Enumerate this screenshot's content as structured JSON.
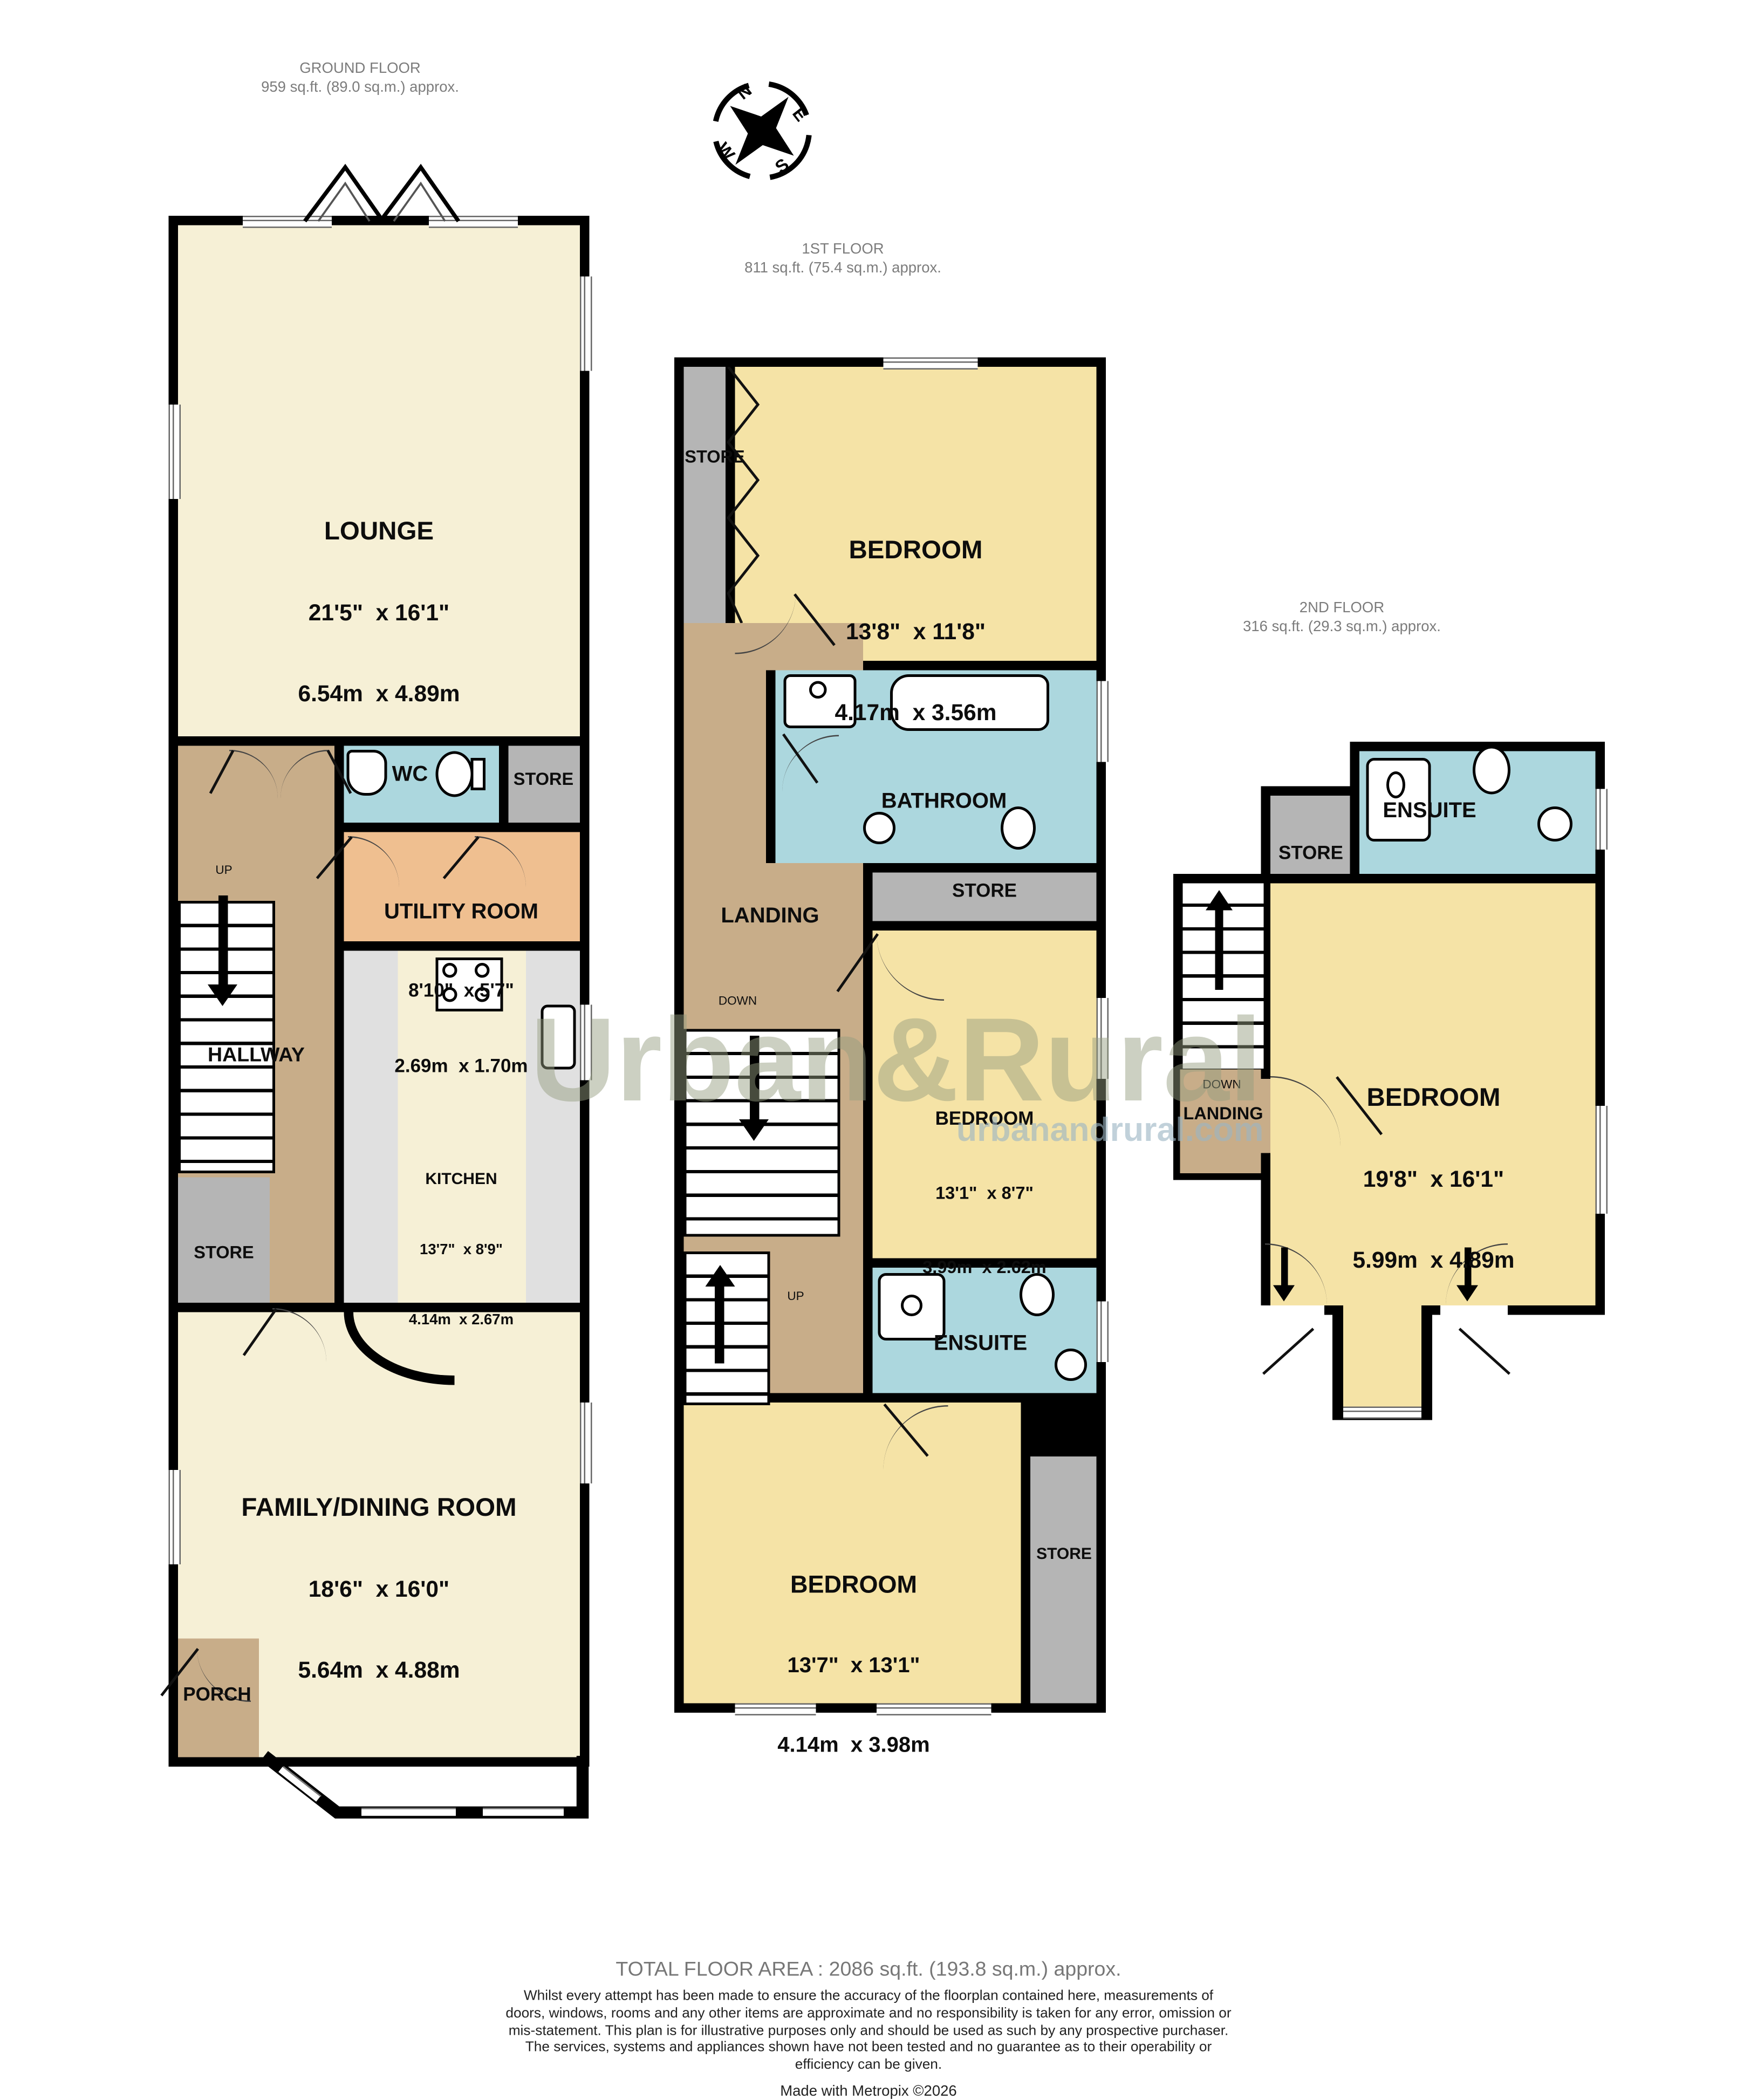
{
  "floors": {
    "ground": {
      "title": "GROUND FLOOR",
      "area": "959 sq.ft. (89.0 sq.m.) approx.",
      "rooms": {
        "lounge": {
          "name": "LOUNGE",
          "size_ft": "21'5\"  x 16'1\"",
          "size_m": "6.54m  x 4.89m"
        },
        "wc": {
          "name": "WC"
        },
        "store_top": {
          "name": "STORE"
        },
        "utility": {
          "name": "UTILITY ROOM",
          "size_ft": "8'10\"  x 5'7\"",
          "size_m": "2.69m  x 1.70m"
        },
        "hallway": {
          "name": "HALLWAY"
        },
        "kitchen": {
          "name": "KITCHEN",
          "size_ft": "13'7\"  x 8'9\"",
          "size_m": "4.14m  x 2.67m"
        },
        "store_mid": {
          "name": "STORE"
        },
        "family": {
          "name": "FAMILY/DINING ROOM",
          "size_ft": "18'6\"  x 16'0\"",
          "size_m": "5.64m  x 4.88m"
        },
        "porch": {
          "name": "PORCH"
        },
        "up": "UP"
      }
    },
    "first": {
      "title": "1ST FLOOR",
      "area": "811 sq.ft. (75.4 sq.m.) approx.",
      "rooms": {
        "store_top": {
          "name": "STORE"
        },
        "bedroom1": {
          "name": "BEDROOM",
          "size_ft": "13'8\"  x 11'8\"",
          "size_m": "4.17m  x 3.56m"
        },
        "bathroom": {
          "name": "BATHROOM"
        },
        "store_mid": {
          "name": "STORE"
        },
        "landing": {
          "name": "LANDING"
        },
        "down": "DOWN",
        "up": "UP",
        "bedroom2": {
          "name": "BEDROOM",
          "size_ft": "13'1\"  x 8'7\"",
          "size_m": "3.99m  x 2.62m"
        },
        "ensuite": {
          "name": "ENSUITE"
        },
        "bedroom3": {
          "name": "BEDROOM",
          "size_ft": "13'7\"  x 13'1\"",
          "size_m": "4.14m  x 3.98m"
        },
        "store_right": {
          "name": "STORE"
        }
      }
    },
    "second": {
      "title": "2ND FLOOR",
      "area": "316 sq.ft. (29.3 sq.m.) approx.",
      "rooms": {
        "store": {
          "name": "STORE"
        },
        "ensuite": {
          "name": "ENSUITE"
        },
        "bedroom": {
          "name": "BEDROOM",
          "size_ft": "19'8\"  x 16'1\"",
          "size_m": "5.99m  x 4.89m"
        },
        "landing": {
          "name": "LANDING"
        },
        "down": "DOWN"
      }
    }
  },
  "compass": {
    "n": "N",
    "e": "E",
    "s": "S",
    "w": "W"
  },
  "watermark": {
    "brand": "Urban&Rural",
    "site": "urbanandrural.com"
  },
  "footer": {
    "total": "TOTAL FLOOR AREA : 2086 sq.ft. (193.8 sq.m.) approx.",
    "disclaimer": "Whilst every attempt has been made to ensure the accuracy of the floorplan contained here, measurements of doors, windows, rooms and any other items are approximate and no responsibility is taken for any error, omission or mis-statement. This plan is for illustrative purposes only and should be used as such by any prospective purchaser. The services, systems and appliances shown have not been tested and no guarantee as to their operability or efficiency can be given.",
    "credit": "Made with Metropix ©2026"
  },
  "colors": {
    "wall": "#000000",
    "living": "#F6F0D6",
    "bedroom": "#F5E3A6",
    "circulation": "#C8AD89",
    "wet_room": "#ACD7DE",
    "utility": "#EFBF90",
    "store": "#B5B5B5"
  }
}
